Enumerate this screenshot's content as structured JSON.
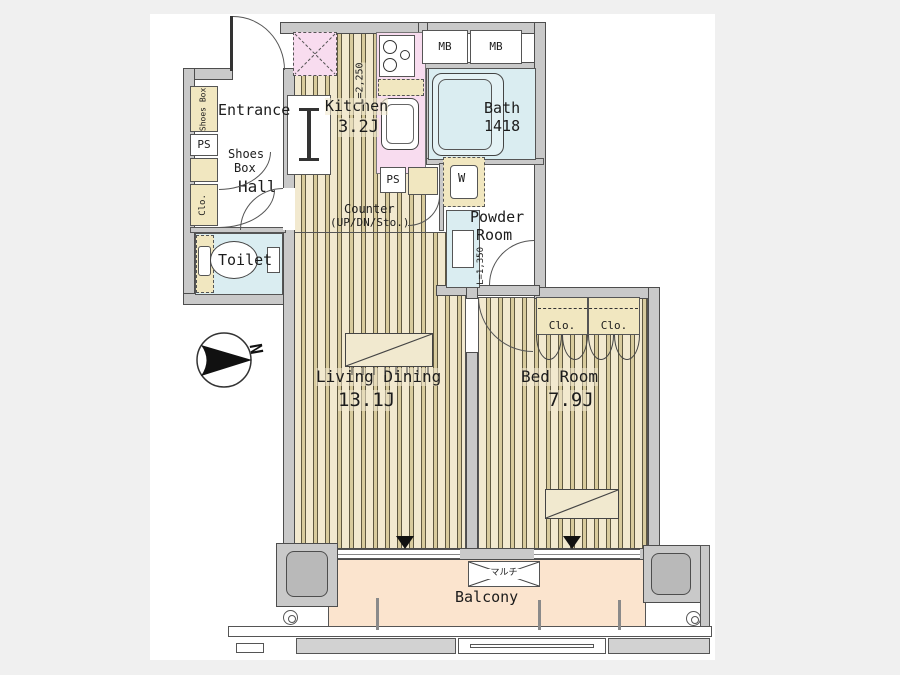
{
  "rooms": {
    "entrance": {
      "label": "Entrance"
    },
    "hall": {
      "label": "Hall"
    },
    "toilet": {
      "label": "Toilet"
    },
    "kitchen": {
      "label": "Kitchen",
      "size": "3.2J",
      "counter_length": "L=2,250"
    },
    "bath": {
      "label": "Bath",
      "size": "1418"
    },
    "powder_room": {
      "line1": "Powder",
      "line2": "Room",
      "vanity_length": "L=1,350"
    },
    "living_dining": {
      "label": "Living Dining",
      "size": "13.1J"
    },
    "bed_room": {
      "label": "Bed Room",
      "size": "7.9J"
    },
    "balcony": {
      "label": "Balcony",
      "multi_box": "マルチ"
    }
  },
  "fixtures": {
    "refrigerator": "R",
    "washing_machine": "W",
    "meter_boxes": [
      "MB",
      "MB"
    ],
    "pipe_space_entrance": "PS",
    "pipe_space_counter": "PS",
    "shoes_box_tall": "Shoes Box",
    "shoes_box_note": {
      "line1": "Shoes",
      "line2": "Box"
    },
    "hall_closet": "Clo.",
    "bedroom_closets": [
      "Clo.",
      "Clo."
    ],
    "counter_note": {
      "line1": "Counter",
      "line2": "(UP/DN/Sto.)"
    }
  },
  "compass": {
    "north": "N"
  },
  "colors": {
    "wall_gray": "#c9c9c9",
    "floor_base": "#f2e9cf",
    "floor_stripe": "#d8cb9d",
    "water_blue": "#daedf1",
    "counter_pink": "#f8dcef",
    "storage_tan": "#f1e7c0",
    "balcony_peach": "#fbe4ce"
  }
}
